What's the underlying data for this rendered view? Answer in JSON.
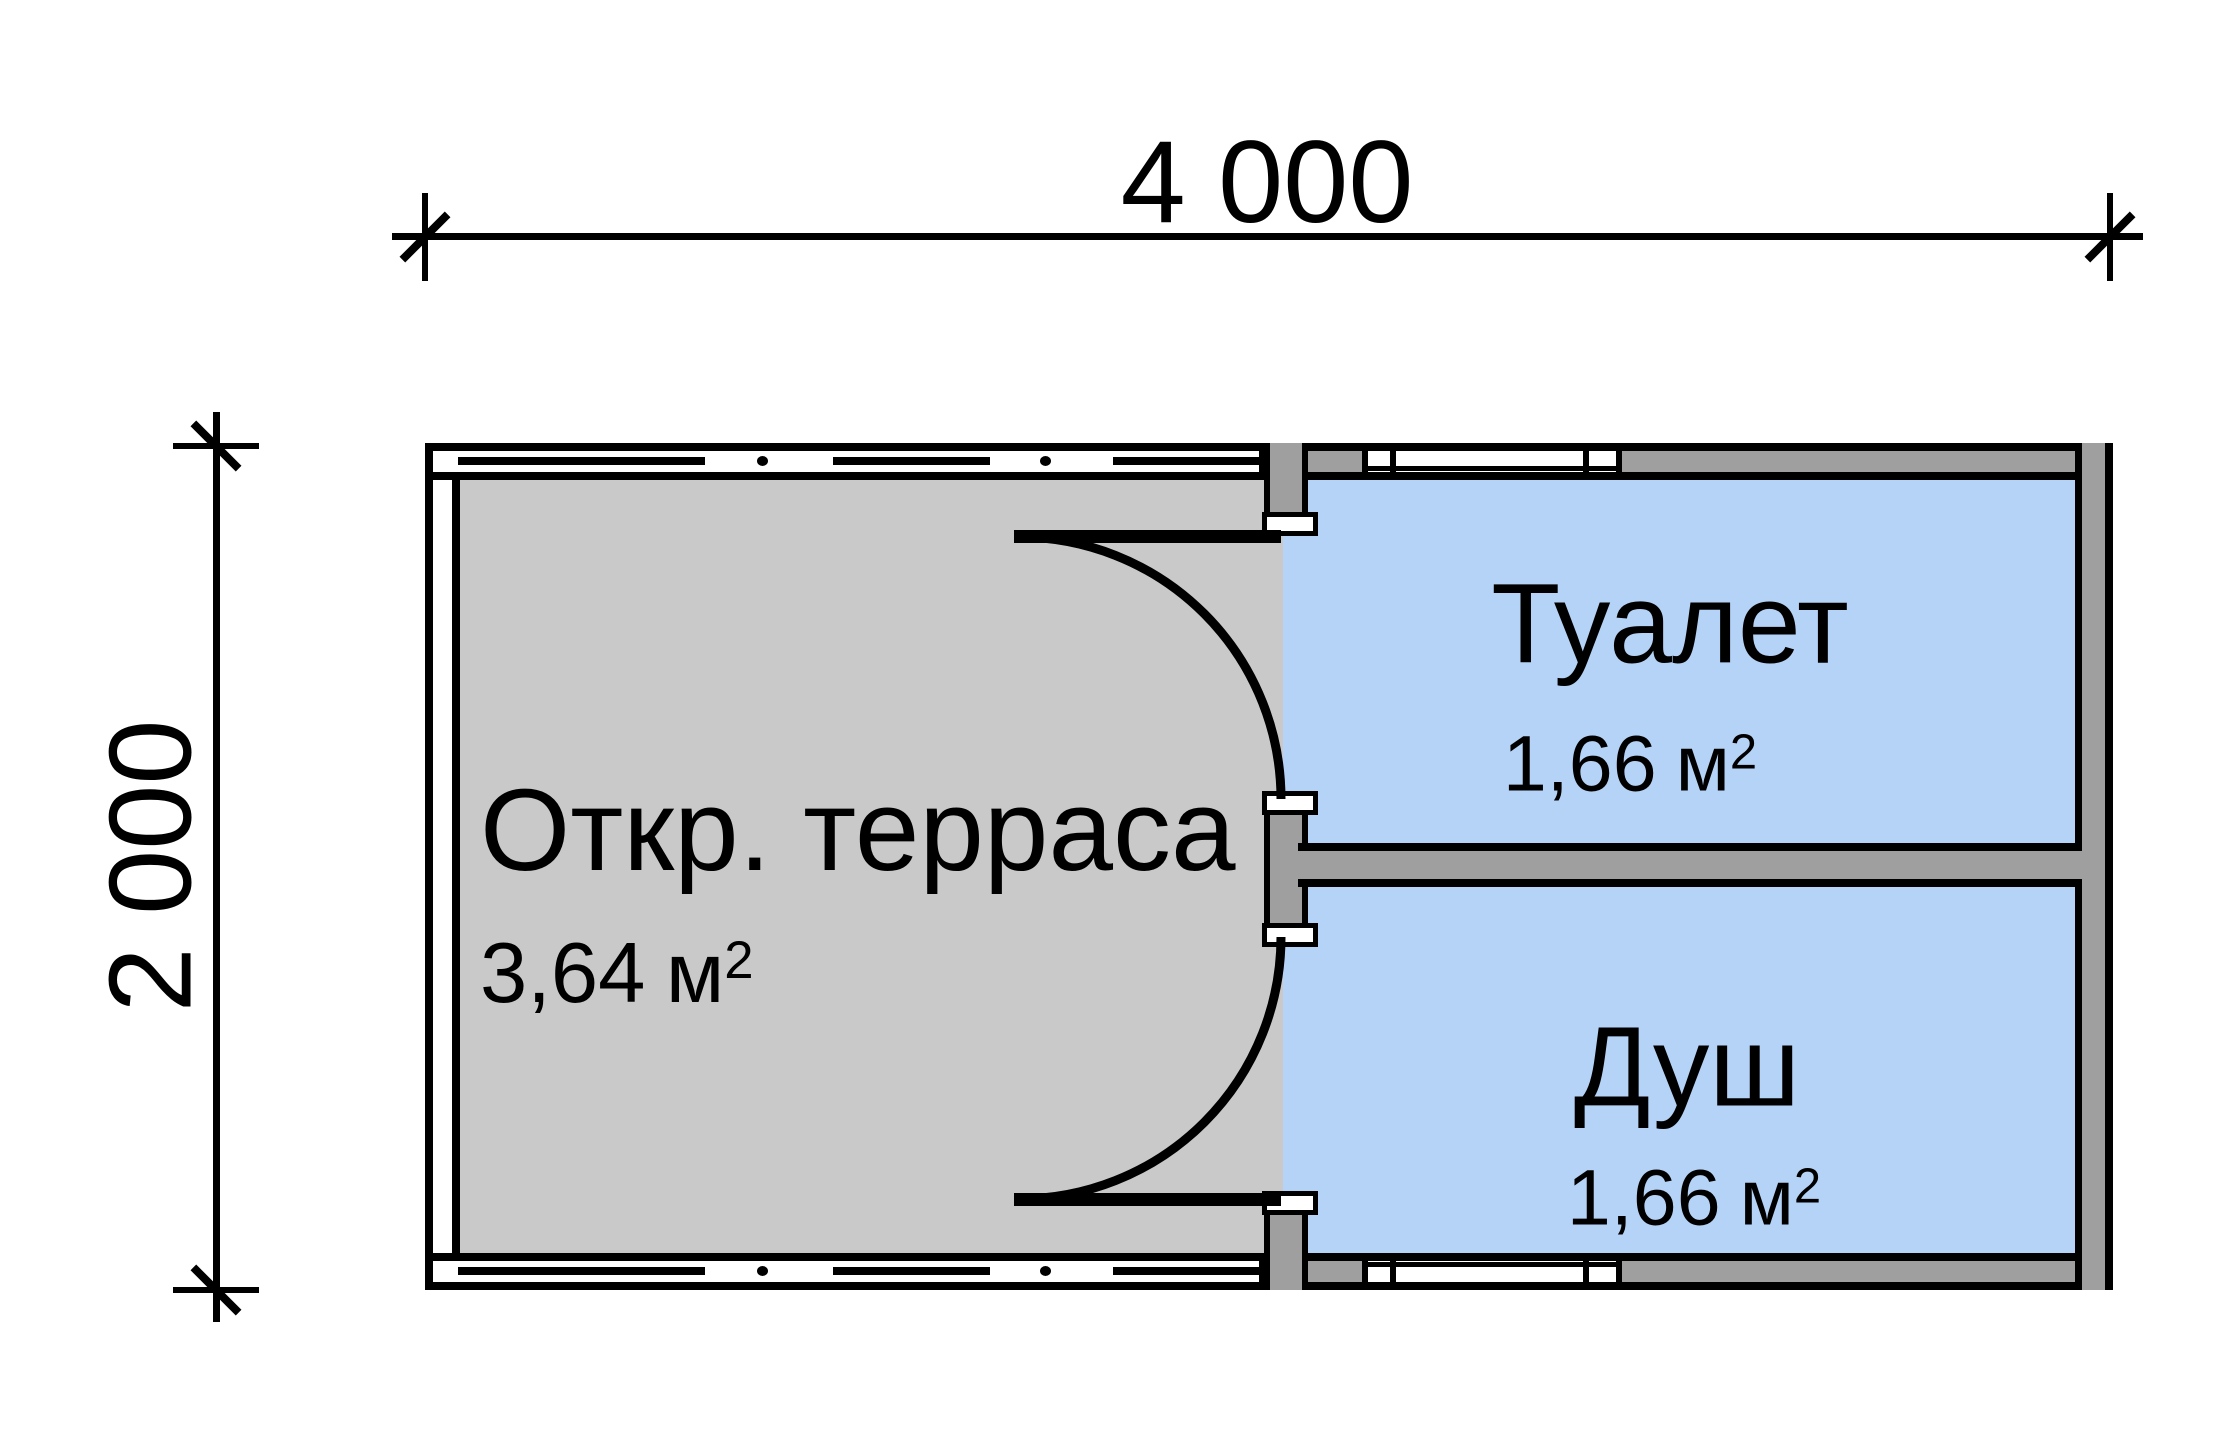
{
  "page": {
    "type": "architectural floor plan",
    "background": "#ffffff"
  },
  "colors": {
    "terrace_fill": "#c9c9c9",
    "wet_room_fill": "#b5d3f7",
    "wall_fill": "#9f9f9f",
    "line": "#000000"
  },
  "dimensions": {
    "width_label": "4 000",
    "height_label": "2 000"
  },
  "rooms": [
    {
      "id": "terrace",
      "name": "Откр. терраса",
      "area_value": "3,64",
      "area_unit": "м",
      "area_sup": "2"
    },
    {
      "id": "toilet",
      "name": "Туалет",
      "area_value": "1,66",
      "area_unit": "м",
      "area_sup": "2"
    },
    {
      "id": "shower",
      "name": "Душ",
      "area_value": "1,66",
      "area_unit": "м",
      "area_sup": "2"
    }
  ]
}
